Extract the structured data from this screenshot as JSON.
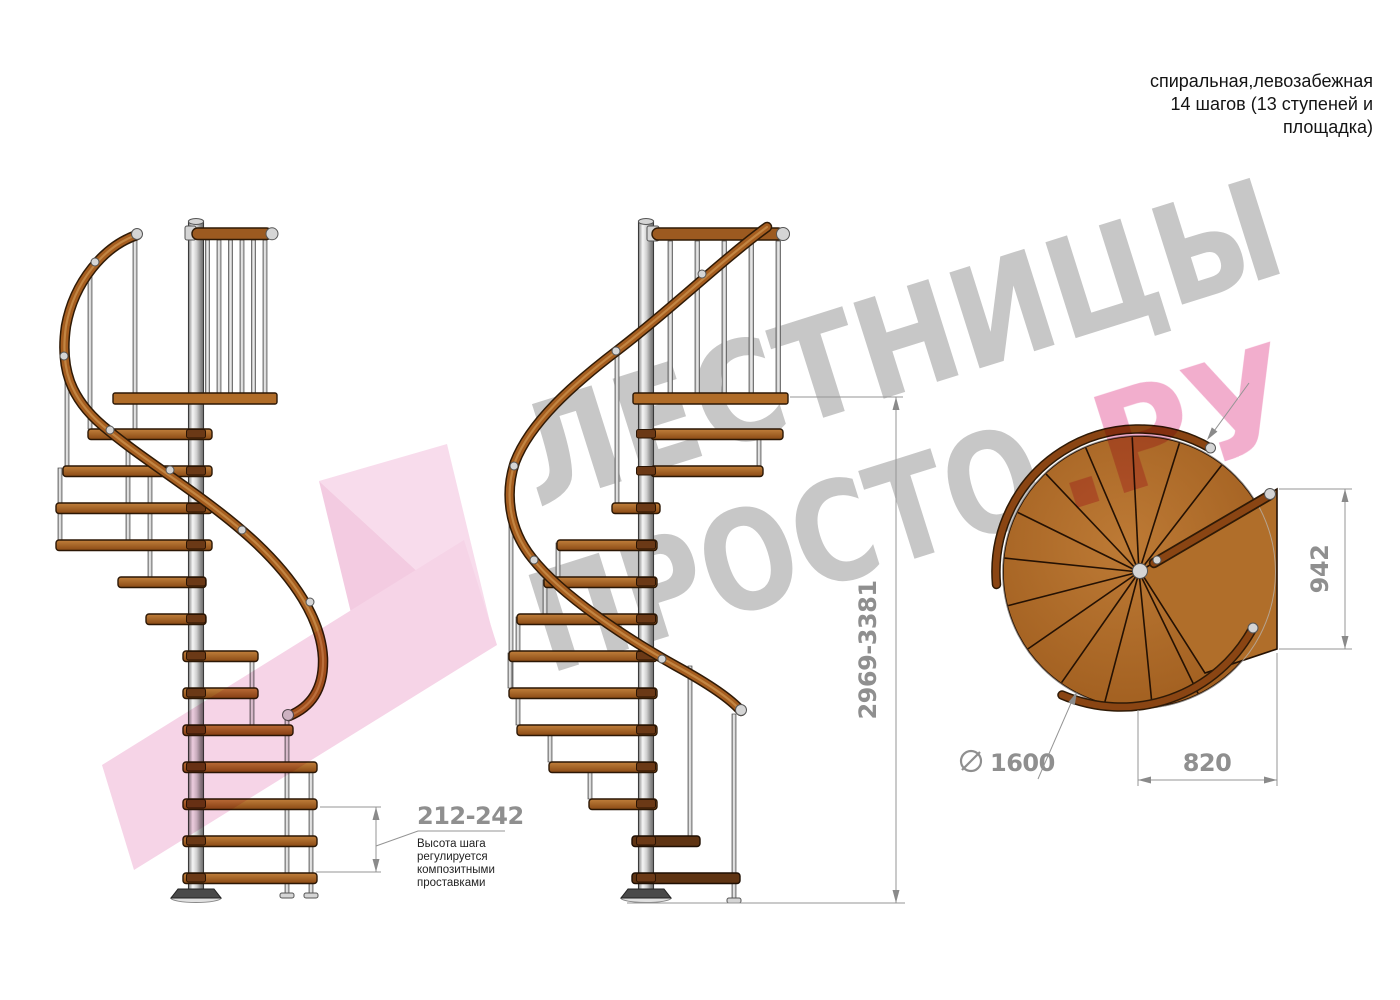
{
  "header": {
    "line1": "спиральная,левозабежная",
    "line2": "14 шагов (13 ступеней и",
    "line3": "площадка)"
  },
  "watermark": {
    "word1": "ЛЕСТНИЦЫ",
    "word2": "ПРОСТО",
    "suffix": ".РУ",
    "gray_color": "#c7c7c7",
    "pink_color": "#f2aecd"
  },
  "dimensions": {
    "step_height": {
      "value": "212-242",
      "note_lines": [
        "Высота шага",
        "регулируется",
        "композитными",
        "проставками"
      ]
    },
    "total_height": {
      "value": "2969-3381"
    },
    "platform_depth": {
      "value": "942"
    },
    "platform_width": {
      "value": "820"
    },
    "diameter": {
      "symbol": "⌀",
      "value": "1600"
    }
  },
  "drawing": {
    "wood_color": "#a96423",
    "rail_color": "#a55d1f",
    "metal_color": "#d5d5d5",
    "dim_color": "#8f8f8f",
    "logo_pink": "#f6d4e7"
  }
}
